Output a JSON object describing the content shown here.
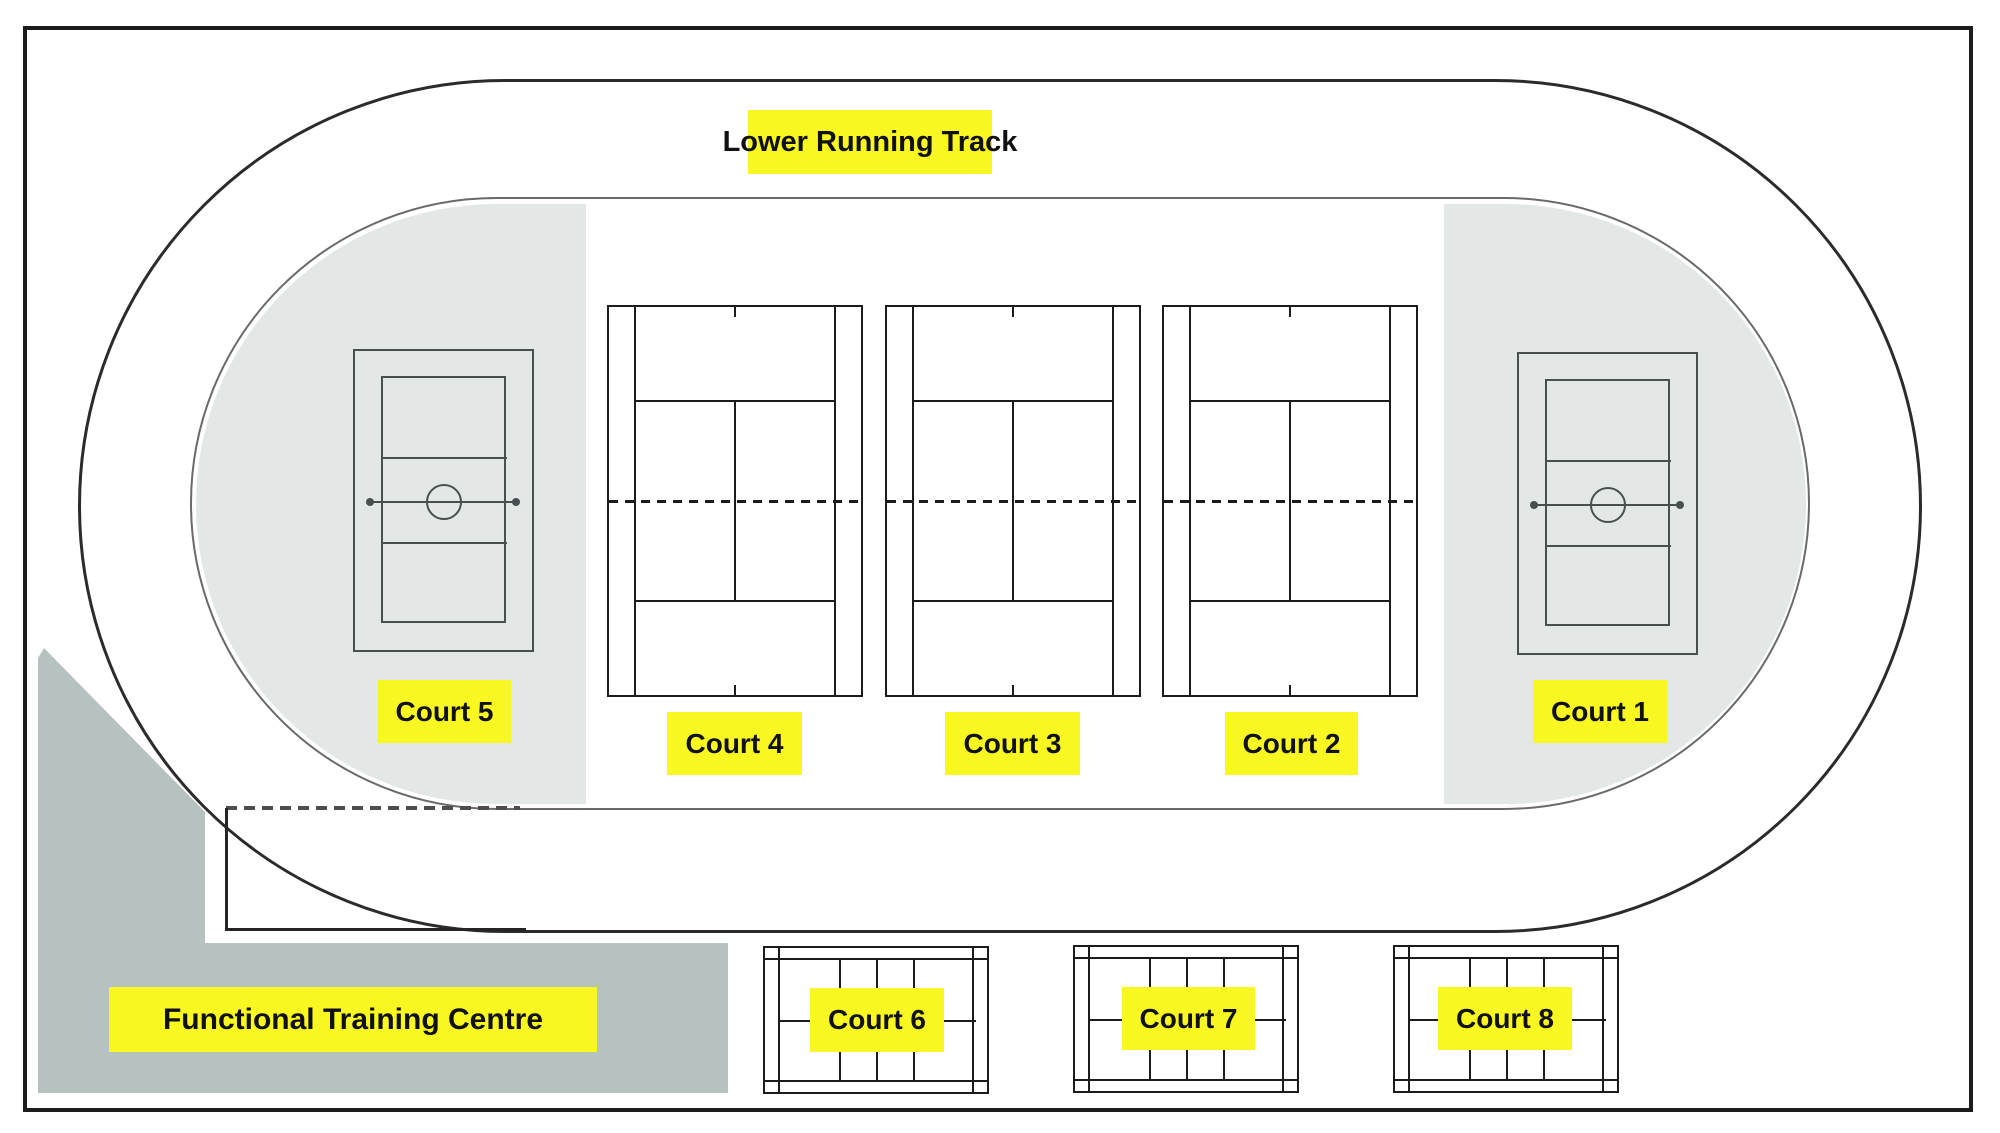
{
  "labels": {
    "running_track": "Lower Running Track",
    "training_centre": "Functional Training Centre",
    "court_1": "Court 1",
    "court_2": "Court 2",
    "court_3": "Court 3",
    "court_4": "Court 4",
    "court_5": "Court 5",
    "court_6": "Court 6",
    "court_7": "Court 7",
    "court_8": "Court 8"
  },
  "colors": {
    "highlight": "#f8f722",
    "zone": "#e3e8e6",
    "training": "#b5c2c0",
    "ink": "#1c1c1c",
    "mid": "#6a6a6a",
    "court": "#474f4f"
  }
}
